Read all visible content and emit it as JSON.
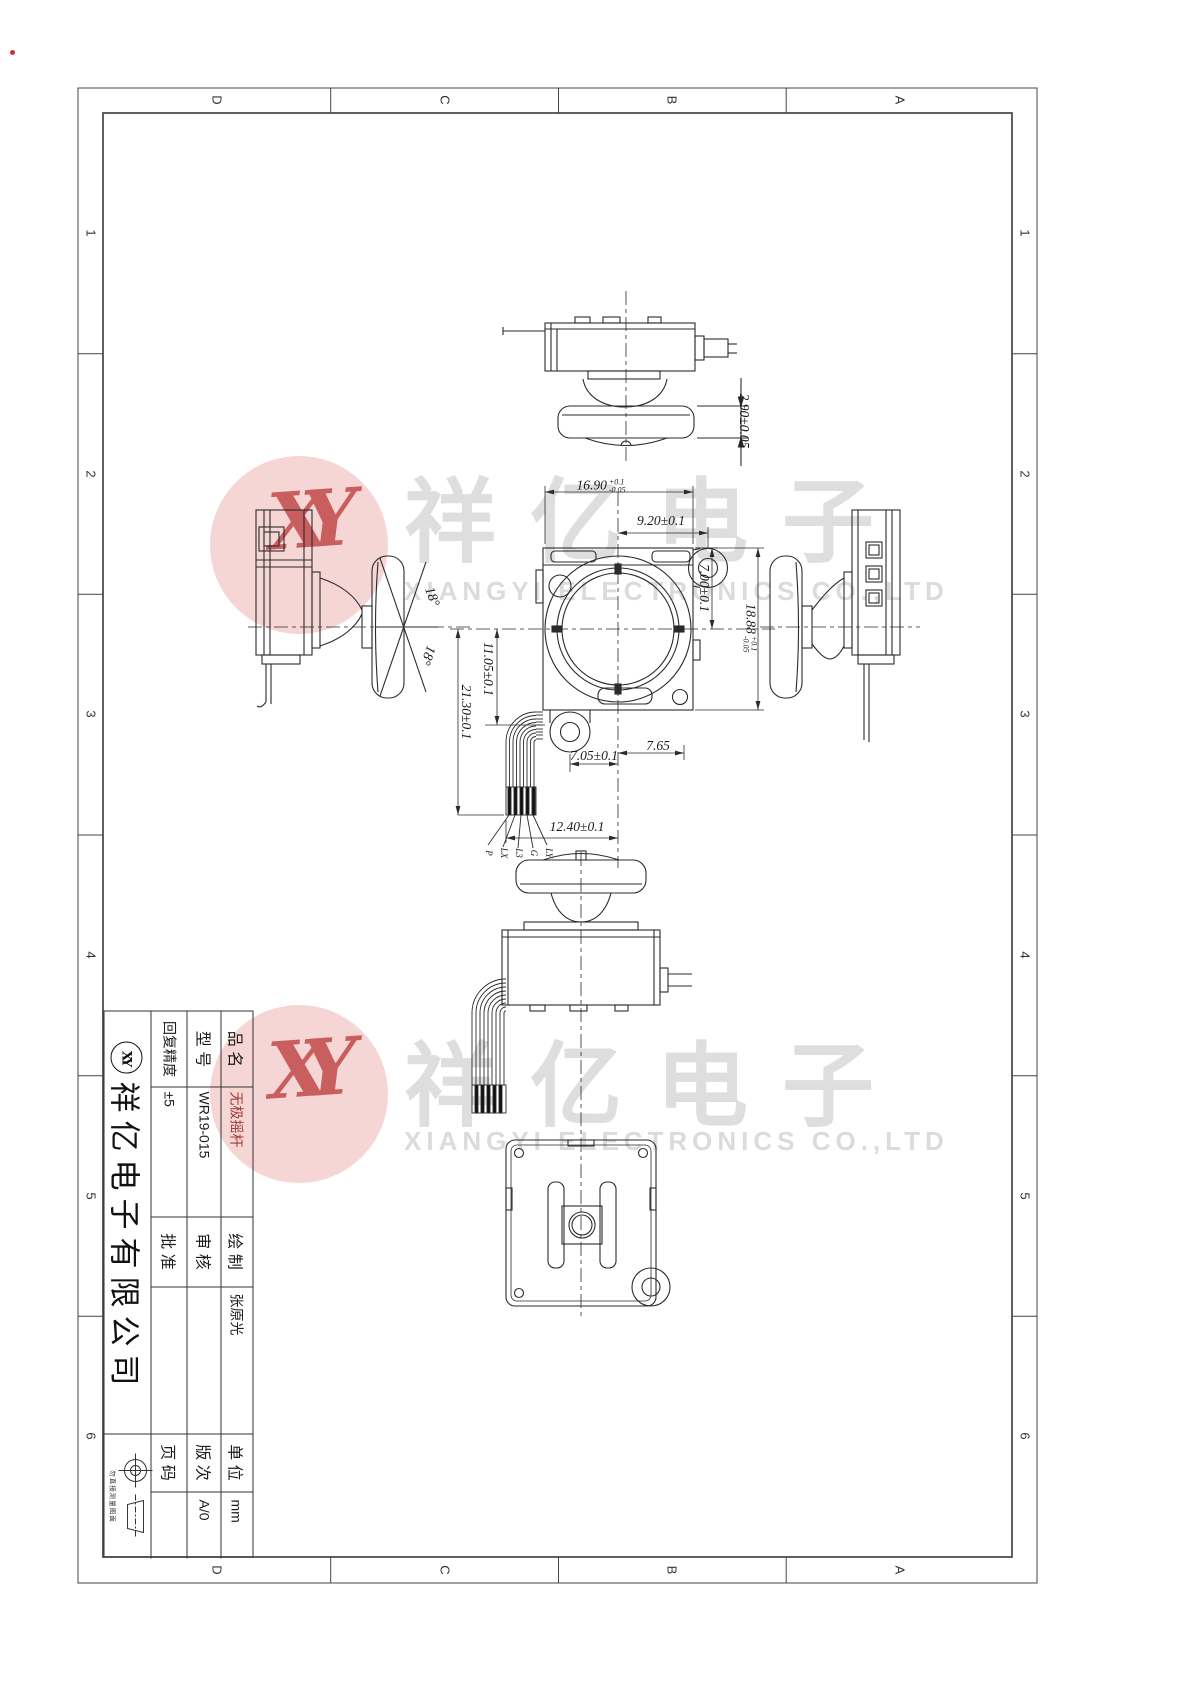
{
  "sheet": {
    "zone_cols": [
      "D",
      "C",
      "B",
      "A"
    ],
    "zone_rows": [
      "1",
      "2",
      "3",
      "4",
      "5",
      "6"
    ]
  },
  "watermark": {
    "monogram": "XY",
    "cn": "祥亿电子",
    "en": "XIANGYI ELECTRONICS CO.,LTD",
    "pink_color": "#f4caca",
    "red_color": "#c24a4a",
    "gray_color": "#c4c4c4"
  },
  "title_block": {
    "product_label": "品 名",
    "product_value": "无极摇杆",
    "model_label": "型 号",
    "model_value": "WR19-015",
    "precision_label": "回复精度",
    "precision_value": "±5",
    "drawn_label": "绘 制",
    "drawn_value": "张原光",
    "checked_label": "审 核",
    "checked_value": "",
    "approved_label": "批 准",
    "approved_value": "",
    "unit_label": "单 位",
    "unit_value": "mm",
    "rev_label": "版 次",
    "rev_value": "A/0",
    "page_label": "页 码",
    "page_value": "",
    "company": "祥亿电子有限公司",
    "logo": "XY",
    "note": "勿直接测量图面"
  },
  "dims": {
    "d290": "2.90±0.05",
    "d1690": "16.90",
    "d1690_plus": "+0.1",
    "d1690_minus": "-0.05",
    "d920": "9.20±0.1",
    "d700": "7.00±0.1",
    "d1888": "18.88",
    "d1888_plus": "+0.1",
    "d1888_minus": "-0.05",
    "d1105": "11.05±0.1",
    "d2130": "21.30±0.1",
    "d705": "7.05±0.1",
    "d765": "7.65",
    "d1240": "12.40±0.1",
    "angle1": "18°",
    "angle2": "18°"
  },
  "wire_labels": [
    "P",
    "LX",
    "L3",
    "G",
    "LY"
  ]
}
